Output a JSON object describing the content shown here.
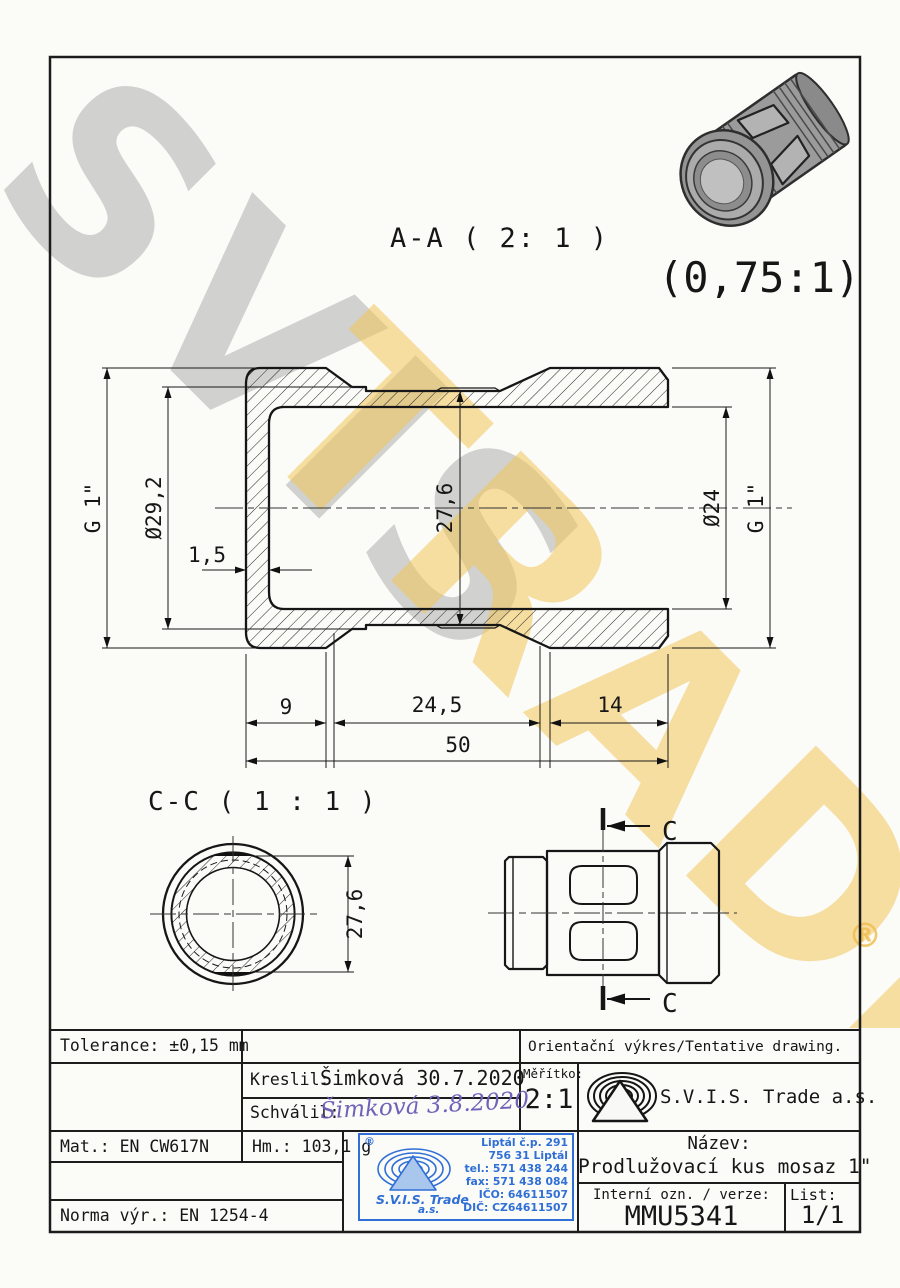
{
  "sheet": {
    "section_a_label": "A-A ( 2: 1 )",
    "render_scale": "(0,75:1)",
    "section_c_label": "C-C ( 1 : 1 )",
    "cut_letter": "C"
  },
  "dims": {
    "g1_left": "G 1\"",
    "dia_29_2": "Ø29,2",
    "wall_1_5": "1,5",
    "af_27_6": "27,6",
    "dia_24": "Ø24",
    "g1_right": "G 1\"",
    "len_9": "9",
    "len_24_5": "24,5",
    "len_14": "14",
    "len_50": "50",
    "cc_27_6": "27,6"
  },
  "watermark": {
    "svis": "SVIS",
    "trade": "TRADE",
    "registered": "®"
  },
  "title_block": {
    "tolerance": "Tolerance: ±0,15 mm",
    "orientacni": "Orientační výkres/Tentative drawing.",
    "kreslil_label": "Kreslil:",
    "kreslil_value": "Šimková 30.7.2020",
    "schvalil_label": "Schválil:",
    "schvalil_signature": "Šimková 3.8.2020",
    "meritko_label": "Měřítko:",
    "meritko_value": "2:1",
    "company": "S.V.I.S. Trade a.s.",
    "mat": "Mat.: EN CW617N",
    "hm": "Hm.: 103,1 g",
    "norma": "Norma výr.: EN 1254-4",
    "nazev_label": "Název:",
    "nazev_value": "Prodlužovací kus mosaz 1\"",
    "interni_label": "Interní ozn. / verze:",
    "interni_value": "MMU5341",
    "list_label": "List:",
    "list_value": "1/1"
  },
  "stamp": {
    "registered": "®",
    "company": "S.V.I.S. Trade",
    "as": "a.s.",
    "lines": [
      "Liptál č.p. 291",
      "756 31 Liptál",
      "tel.: 571 438 244",
      "fax: 571 438 084",
      "IČO: 64611507",
      "DIČ: CZ64611507"
    ],
    "color": "#2f6fd6"
  },
  "colors": {
    "line": "#161616",
    "stamp_blue": "#2f6fd6",
    "watermark_gold": "#f2c458",
    "watermark_gray": "#7d7d7d",
    "signature_blue": "#6f62b8"
  }
}
